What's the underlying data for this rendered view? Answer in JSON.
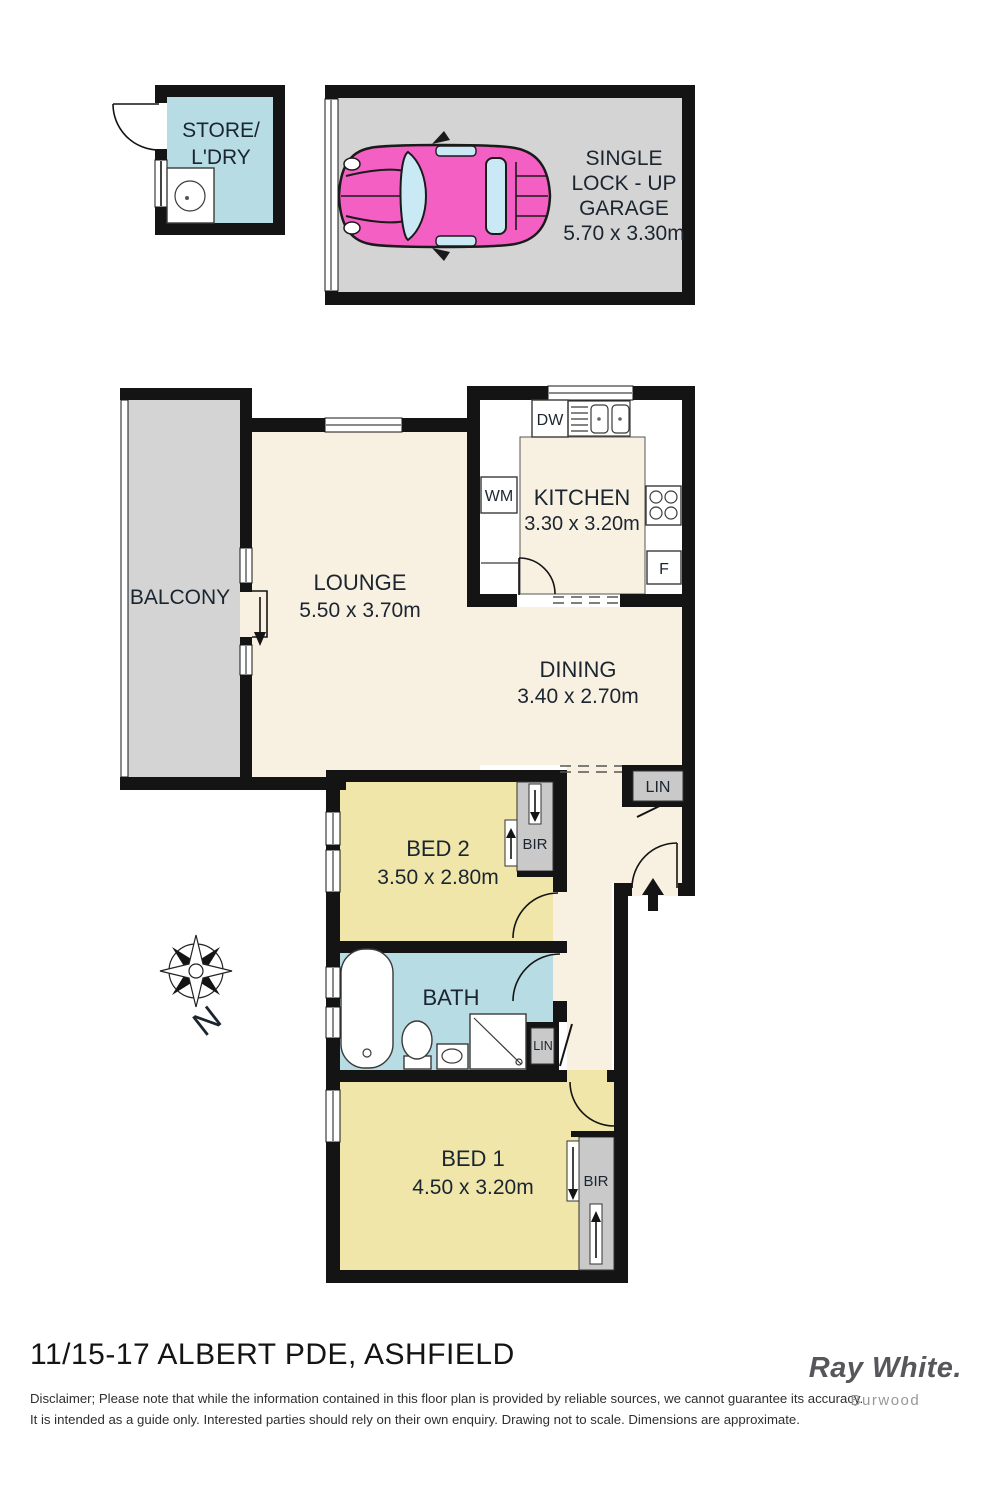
{
  "plan": {
    "store": {
      "name_line1": "STORE/",
      "name_line2": "L'DRY"
    },
    "garage": {
      "line1": "SINGLE",
      "line2": "LOCK - UP",
      "line3": "GARAGE",
      "line4": "5.70 x 3.30m"
    },
    "balcony": {
      "name": "BALCONY"
    },
    "lounge": {
      "name": "LOUNGE",
      "dims": "5.50 x 3.70m"
    },
    "kitchen": {
      "name": "KITCHEN",
      "dims": "3.30 x 3.20m",
      "dishwasher": "DW",
      "washing_machine": "WM",
      "fridge": "F"
    },
    "dining": {
      "name": "DINING",
      "dims": "3.40 x 2.70m"
    },
    "hall": {
      "linen": "LIN"
    },
    "bed2": {
      "name": "BED 2",
      "dims": "3.50 x 2.80m",
      "robe": "BIR"
    },
    "bath": {
      "name": "BATH",
      "linen": "LIN"
    },
    "bed1": {
      "name": "BED 1",
      "dims": "4.50 x 3.20m",
      "robe": "BIR"
    },
    "compass": {
      "north": "N"
    }
  },
  "footer": {
    "address": "11/15-17 ALBERT PDE, ASHFIELD",
    "disclaimer_line1": "Disclaimer; Please note that while the information contained in this floor plan is provided by reliable sources, we cannot guarantee its accuracy.",
    "disclaimer_line2": "It is intended as a guide only. Interested parties should rely on their own enquiry. Drawing not to scale.  Dimensions are approximate.",
    "brand": "Ray White.",
    "office": "Burwood"
  },
  "colors": {
    "wall": "#141414",
    "living_floor": "#f8f1e1",
    "bedroom_floor": "#f0e6aa",
    "wet_area_floor": "#b7dce3",
    "outdoor_floor": "#d4d4d4",
    "car_pink": "#f45fc4",
    "car_glass": "#c9e9f4",
    "brand_grey": "#57575b"
  }
}
